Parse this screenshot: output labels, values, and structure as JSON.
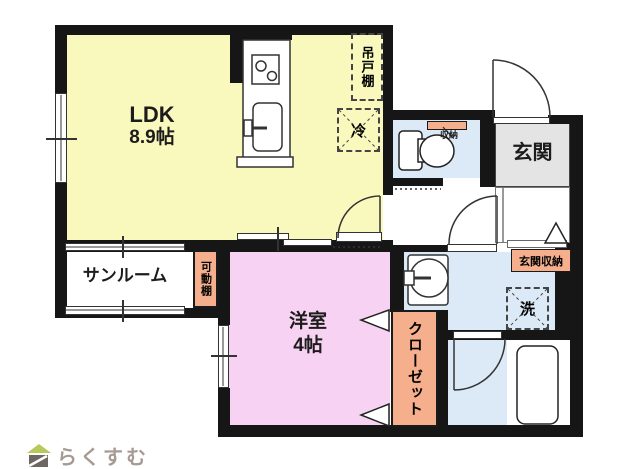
{
  "floorplan": {
    "rooms": {
      "ldk": {
        "label": "LDK",
        "size": "8.9帖"
      },
      "sunroom": {
        "label": "サンルーム"
      },
      "western_room": {
        "label": "洋室",
        "size": "4帖"
      },
      "entrance": {
        "label": "玄関"
      },
      "closet": {
        "label": "クローゼット"
      }
    },
    "fixtures": {
      "hanging_cupboard": "吊戸棚",
      "refrigerator": "冷",
      "toilet_storage": "収納",
      "movable_shelf": "可動棚",
      "entrance_storage": "玄関収納",
      "washing_machine": "洗"
    },
    "colors": {
      "wall": "#161616",
      "ldk_yellow": "#FAF9BD",
      "room_pink": "#F8D2F2",
      "wet_area_blue": "#DCE9F6",
      "entrance_gray": "#E4E4E4",
      "label_orange": "#F5AF8C",
      "logo_green": "#B6CA5B",
      "logo_gray": "#6E6661",
      "logo_text": "#A79A92"
    }
  },
  "footer": {
    "logo_text": "らくすむ"
  }
}
